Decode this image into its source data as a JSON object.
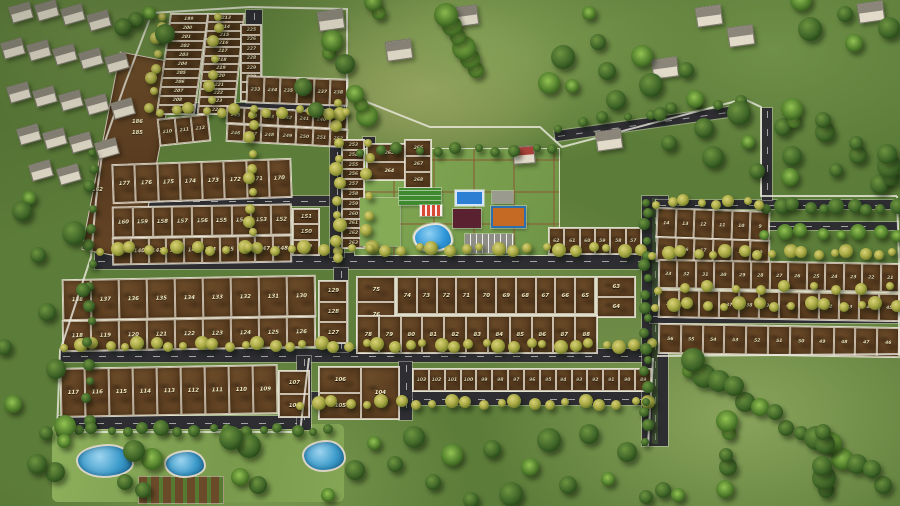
{
  "scene": {
    "type": "aerial-masterplan-render",
    "colors": {
      "grass": "#5c7c39",
      "soil": "#6b4a28",
      "road": "#2d2d32",
      "boundary_wall": "#eceadf",
      "plot_number": "#f7f0c6",
      "pool": "#2e96d8",
      "tennis_court": "#2d7fd3",
      "multi_court": "#c56a25",
      "clubhouse_roof": "#5a2230",
      "flowering_tree": "#a9a945",
      "dark_tree": "#42682a"
    }
  },
  "plot_blocks": [
    {
      "name": "nw-col-a",
      "x": 163,
      "y": 13,
      "w": 37,
      "h": 100,
      "layout": "col",
      "small": true,
      "tf": "skewX(-8deg)",
      "cells": [
        "199",
        "200",
        "201",
        "202",
        "203",
        "204",
        "205",
        "206",
        "207",
        "208",
        "209"
      ]
    },
    {
      "name": "nw-col-b",
      "x": 202,
      "y": 13,
      "w": 36,
      "h": 100,
      "layout": "col",
      "small": true,
      "tf": "skewX(-6deg)",
      "cells": [
        "213",
        "214",
        "215",
        "216",
        "217",
        "218",
        "219",
        "220",
        "221",
        "222",
        "223",
        "224"
      ]
    },
    {
      "name": "nw-col-c",
      "x": 240,
      "y": 24,
      "w": 20,
      "h": 76,
      "layout": "col",
      "small": true,
      "cells": [
        "225",
        "226",
        "227",
        "228",
        "229",
        "230",
        "231",
        "232"
      ]
    },
    {
      "name": "nw-cells-210",
      "x": 158,
      "y": 116,
      "w": 50,
      "h": 26,
      "layout": "row",
      "small": true,
      "tf": "rotate(-6deg)",
      "cells": [
        "210",
        "211",
        "212"
      ]
    },
    {
      "name": "nw-row-233",
      "x": 246,
      "y": 77,
      "w": 100,
      "h": 26,
      "layout": "row",
      "small": true,
      "tf": "rotate(2deg)",
      "cells": [
        "233",
        "234",
        "235",
        "236",
        "237",
        "238"
      ]
    },
    {
      "name": "nw-row-239",
      "x": 226,
      "y": 109,
      "w": 120,
      "h": 16,
      "layout": "row",
      "small": true,
      "tf": "rotate(3deg)",
      "cells": [
        "245",
        "244",
        "243",
        "242",
        "241",
        "240",
        "239"
      ]
    },
    {
      "name": "nw-row-246",
      "x": 226,
      "y": 126,
      "w": 120,
      "h": 17,
      "layout": "row",
      "small": true,
      "tf": "rotate(3deg)",
      "cells": [
        "246",
        "247",
        "248",
        "249",
        "250",
        "251",
        "252"
      ]
    },
    {
      "name": "mid-row-170s",
      "x": 112,
      "y": 161,
      "w": 178,
      "h": 38,
      "layout": "row",
      "tf": "rotate(-2deg)",
      "cells": [
        "177",
        "176",
        "175",
        "174",
        "173",
        "172",
        "171",
        "170"
      ]
    },
    {
      "name": "mid-row-150s",
      "x": 112,
      "y": 205,
      "w": 178,
      "h": 30,
      "layout": "row",
      "tf": "rotate(-1deg)",
      "cells": [
        "160",
        "159",
        "158",
        "157",
        "156",
        "155",
        "154",
        "153",
        "152"
      ]
    },
    {
      "name": "mid-col-149",
      "x": 292,
      "y": 208,
      "w": 26,
      "h": 46,
      "layout": "col",
      "cells": [
        "151",
        "150",
        "149"
      ]
    },
    {
      "name": "mid-row-140s",
      "x": 112,
      "y": 236,
      "w": 178,
      "h": 26,
      "layout": "row",
      "tf": "rotate(-1deg)",
      "cells": [
        "139",
        "140",
        "141",
        "142",
        "143",
        "144",
        "145",
        "146",
        "147",
        "148"
      ]
    },
    {
      "name": "mid-row-130s",
      "x": 62,
      "y": 277,
      "w": 252,
      "h": 40,
      "layout": "row",
      "tf": "rotate(-1deg)",
      "cells": [
        "138",
        "137",
        "136",
        "135",
        "134",
        "133",
        "132",
        "131",
        "130"
      ]
    },
    {
      "name": "mid-col-127",
      "x": 318,
      "y": 280,
      "w": 28,
      "h": 62,
      "layout": "col",
      "cells": [
        "129",
        "128",
        "127"
      ]
    },
    {
      "name": "mid-row-120s",
      "x": 62,
      "y": 318,
      "w": 252,
      "h": 30,
      "layout": "row",
      "tf": "rotate(-1deg)",
      "cells": [
        "118",
        "119",
        "120",
        "121",
        "122",
        "123",
        "124",
        "125",
        "126"
      ]
    },
    {
      "name": "sw-row-110s",
      "x": 60,
      "y": 366,
      "w": 216,
      "h": 48,
      "layout": "row",
      "tf": "rotate(-1deg)",
      "cells": [
        "117",
        "116",
        "115",
        "114",
        "113",
        "112",
        "111",
        "110",
        "109"
      ]
    },
    {
      "name": "sw-col-107",
      "x": 278,
      "y": 370,
      "w": 30,
      "h": 46,
      "layout": "col",
      "cells": [
        "107",
        "108"
      ]
    },
    {
      "name": "sw-trio-104",
      "x": 318,
      "y": 366,
      "w": 80,
      "h": 52,
      "layout": "trio",
      "cells": [
        "106",
        "104",
        "105"
      ]
    },
    {
      "name": "south-row-89",
      "x": 412,
      "y": 368,
      "w": 238,
      "h": 22,
      "layout": "row",
      "small": true,
      "cells": [
        "103",
        "102",
        "101",
        "100",
        "99",
        "98",
        "97",
        "96",
        "95",
        "94",
        "93",
        "92",
        "91",
        "90",
        "89"
      ]
    },
    {
      "name": "center-col-75",
      "x": 356,
      "y": 276,
      "w": 38,
      "h": 76,
      "layout": "col",
      "cells": [
        "75",
        "76",
        "77"
      ]
    },
    {
      "name": "center-row-65",
      "x": 396,
      "y": 276,
      "w": 198,
      "h": 37,
      "layout": "row",
      "cells": [
        "74",
        "73",
        "72",
        "71",
        "70",
        "69",
        "68",
        "67",
        "66",
        "65"
      ]
    },
    {
      "name": "center-col-63",
      "x": 596,
      "y": 276,
      "w": 38,
      "h": 40,
      "layout": "col",
      "cells": [
        "63",
        "64"
      ]
    },
    {
      "name": "center-row-78",
      "x": 356,
      "y": 315,
      "w": 240,
      "h": 37,
      "layout": "row",
      "cells": [
        "78",
        "79",
        "80",
        "81",
        "82",
        "83",
        "84",
        "85",
        "86",
        "87",
        "88"
      ]
    },
    {
      "name": "center-row-57",
      "x": 548,
      "y": 227,
      "w": 92,
      "h": 26,
      "layout": "row",
      "small": true,
      "cells": [
        "62",
        "61",
        "60",
        "59",
        "58",
        "57"
      ]
    },
    {
      "name": "top-col-253",
      "x": 341,
      "y": 139,
      "w": 22,
      "h": 108,
      "layout": "col",
      "small": true,
      "cells": [
        "253",
        "254",
        "255",
        "256",
        "257",
        "258",
        "259",
        "260",
        "261",
        "262",
        "263"
      ]
    },
    {
      "name": "top-col-264",
      "x": 366,
      "y": 143,
      "w": 44,
      "h": 36,
      "layout": "col",
      "small": true,
      "cells": [
        "265",
        "264"
      ]
    },
    {
      "name": "top-col-266",
      "x": 404,
      "y": 139,
      "w": 26,
      "h": 48,
      "layout": "col",
      "small": true,
      "cells": [
        "266",
        "267",
        "268"
      ]
    },
    {
      "name": "ne-row-9",
      "x": 656,
      "y": 209,
      "w": 112,
      "h": 29,
      "layout": "row",
      "small": true,
      "tf": "rotate(2deg)",
      "cells": [
        "14",
        "13",
        "12",
        "11",
        "10",
        "9"
      ]
    },
    {
      "name": "ne-row-15",
      "x": 656,
      "y": 238,
      "w": 112,
      "h": 24,
      "layout": "row",
      "small": true,
      "tf": "rotate(2deg)",
      "cells": [
        "15",
        "16",
        "17",
        "18",
        "19",
        "20"
      ]
    },
    {
      "name": "e-row-21",
      "x": 658,
      "y": 261,
      "w": 240,
      "h": 28,
      "layout": "row",
      "small": true,
      "tf": "rotate(1deg)",
      "cells": [
        "33",
        "32",
        "31",
        "30",
        "29",
        "28",
        "27",
        "26",
        "25",
        "24",
        "23",
        "22",
        "21"
      ]
    },
    {
      "name": "e-row-34",
      "x": 658,
      "y": 291,
      "w": 240,
      "h": 27,
      "layout": "row",
      "small": true,
      "tf": "rotate(1deg)",
      "cells": [
        "34",
        "35",
        "36",
        "37",
        "38",
        "39",
        "40",
        "41",
        "42",
        "43",
        "44",
        "45"
      ]
    },
    {
      "name": "e-row-46",
      "x": 658,
      "y": 325,
      "w": 240,
      "h": 29,
      "layout": "row",
      "small": true,
      "tf": "rotate(1deg)",
      "cells": [
        "56",
        "55",
        "54",
        "53",
        "52",
        "51",
        "50",
        "49",
        "48",
        "47",
        "46"
      ]
    }
  ],
  "floating_labels": [
    {
      "text": "186",
      "x": 132,
      "y": 119
    },
    {
      "text": "185",
      "x": 132,
      "y": 130
    },
    {
      "text": "162",
      "x": 92,
      "y": 187
    }
  ],
  "amenities": [
    {
      "name": "amenity-area",
      "x": 354,
      "y": 148,
      "w": 204,
      "h": 106,
      "base": true
    },
    {
      "name": "garden-lawn",
      "x": 360,
      "y": 198,
      "w": 40,
      "h": 48,
      "color": "#85ab57"
    },
    {
      "name": "lawn-court",
      "x": 399,
      "y": 188,
      "w": 42,
      "h": 17,
      "color": "#3f8a2e",
      "stripes": "h"
    },
    {
      "name": "tennis-court",
      "x": 455,
      "y": 190,
      "w": 29,
      "h": 16,
      "color": "#2d7fd3",
      "lines": true
    },
    {
      "name": "utility-pad",
      "x": 492,
      "y": 191,
      "w": 21,
      "h": 12,
      "color": "#9a9a8e"
    },
    {
      "name": "kids-play-area",
      "x": 420,
      "y": 205,
      "w": 22,
      "h": 11,
      "color": "#d84a35",
      "stripes": "r"
    },
    {
      "name": "clubhouse",
      "x": 453,
      "y": 209,
      "w": 28,
      "h": 19,
      "color": "#5a2230"
    },
    {
      "name": "multi-court",
      "x": 491,
      "y": 206,
      "w": 31,
      "h": 18,
      "color": "#c56a25",
      "ring": "#2b6fae"
    },
    {
      "name": "swimming-pool",
      "x": 413,
      "y": 223,
      "w": 36,
      "h": 25,
      "color": "#2e96d8",
      "blob": true
    },
    {
      "name": "parking",
      "x": 465,
      "y": 234,
      "w": 48,
      "h": 19,
      "color": "#8e8e86",
      "stripes": "v"
    }
  ]
}
